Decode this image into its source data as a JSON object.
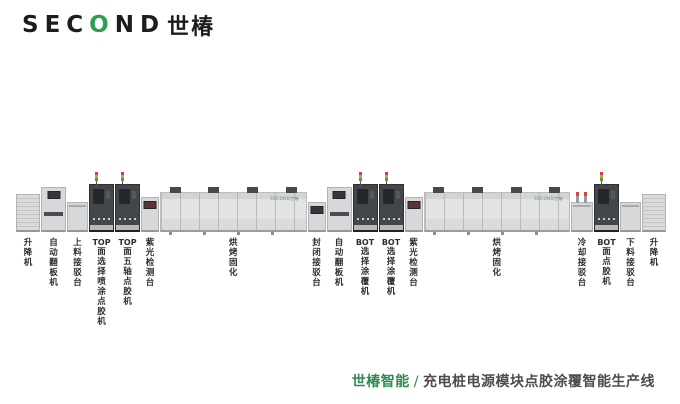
{
  "logo": {
    "pre": "SEC",
    "o": "O",
    "post": "ND",
    "cjk": "世椿"
  },
  "oven_logo": "SECOND世椿",
  "machines": [
    {
      "name": "lift-infeed",
      "type": "lift",
      "tower": false,
      "prefix": "",
      "label": "升降机"
    },
    {
      "name": "auto-board-flipper-1",
      "type": "flipper",
      "tower": false,
      "prefix": "",
      "label": "自动翻板机"
    },
    {
      "name": "loading-conveyor",
      "type": "conveyor",
      "tower": false,
      "prefix": "",
      "label": "上料接驳台"
    },
    {
      "name": "top-selective-spray-dispenser",
      "type": "dark",
      "tower": true,
      "prefix": "TOP",
      "label": "面选择喷涂点胶机"
    },
    {
      "name": "top-five-axis-dispenser",
      "type": "dark",
      "tower": true,
      "prefix": "TOP",
      "label": "面五轴点胶机"
    },
    {
      "name": "uv-inspection-station-1",
      "type": "inspect",
      "tower": false,
      "prefix": "",
      "label": "紫光检测台"
    },
    {
      "name": "curing-oven-1",
      "type": "oven",
      "tower": false,
      "prefix": "",
      "label": "烘烤固化"
    },
    {
      "name": "sealed-conveyor",
      "type": "conveyor-screen",
      "tower": false,
      "prefix": "",
      "label": "封闭接驳台"
    },
    {
      "name": "auto-board-flipper-2",
      "type": "flipper",
      "tower": false,
      "prefix": "",
      "label": "自动翻板机"
    },
    {
      "name": "bot-selective-coater-1",
      "type": "dark",
      "tower": true,
      "prefix": "BOT",
      "label": "选择涂覆机"
    },
    {
      "name": "bot-selective-coater-2",
      "type": "dark",
      "tower": true,
      "prefix": "BOT",
      "label": "选择涂覆机"
    },
    {
      "name": "uv-inspection-station-2",
      "type": "inspect",
      "tower": false,
      "prefix": "",
      "label": "紫光检测台"
    },
    {
      "name": "curing-oven-2",
      "type": "oven",
      "tower": false,
      "prefix": "",
      "label": "烘烤固化"
    },
    {
      "name": "cooling-conveyor",
      "type": "conveyor-posts",
      "tower": false,
      "prefix": "",
      "label": "冷却接驳台"
    },
    {
      "name": "bot-dispenser",
      "type": "dark",
      "tower": true,
      "prefix": "BOT",
      "label": "面点胶机"
    },
    {
      "name": "unloading-conveyor",
      "type": "conveyor",
      "tower": false,
      "prefix": "",
      "label": "下料接驳台"
    },
    {
      "name": "lift-outfeed",
      "type": "lift",
      "tower": false,
      "prefix": "",
      "label": "升降机"
    }
  ],
  "caption": {
    "brand": "世椿智能",
    "separator": "/",
    "title": "充电桩电源模块点胶涂覆智能生产线"
  },
  "colors": {
    "accent_green": "#2f9e55",
    "caption_green": "#2e8b4f",
    "dark_machine": "#43464b",
    "light_machine": "#d7d8da"
  }
}
